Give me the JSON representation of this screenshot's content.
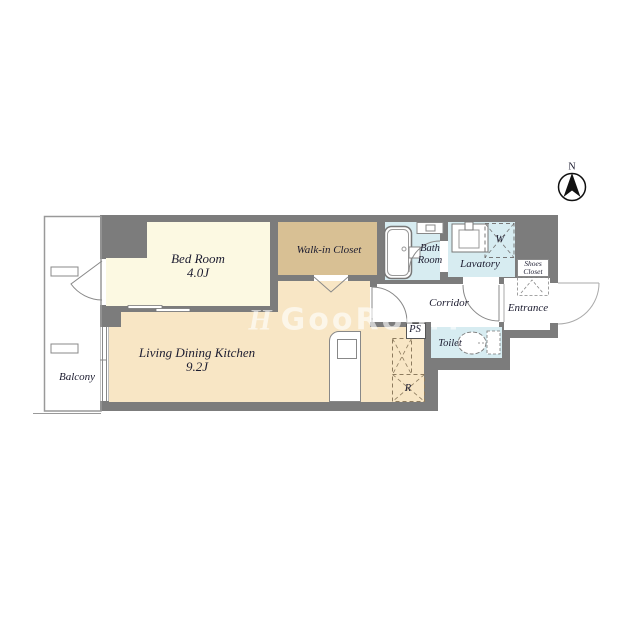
{
  "compass": {
    "label": "N"
  },
  "watermark": {
    "logo": "H",
    "text": "GooRooM"
  },
  "colors": {
    "wall": "#7c7c7c",
    "bedroom_floor": "#fcf9e2",
    "closet_floor": "#d8c094",
    "ldk_floor": "#f8e6c5",
    "wet_area_floor": "#d7ecf1",
    "outline": "#8a8a8a"
  },
  "rooms": {
    "balcony": {
      "label": "Balcony"
    },
    "bedroom": {
      "label": "Bed Room",
      "size": "4.0J"
    },
    "walk_in_closet": {
      "label": "Walk-in Closet"
    },
    "bath": {
      "label_line1": "Bath",
      "label_line2": "Room"
    },
    "lavatory": {
      "label": "Lavatory"
    },
    "washer": {
      "label": "W"
    },
    "shoes_closet": {
      "label_line1": "Shoes",
      "label_line2": "Closet"
    },
    "entrance": {
      "label": "Entrance"
    },
    "corridor": {
      "label": "Corridor"
    },
    "toilet": {
      "label": "Toilet"
    },
    "pipe_space": {
      "label": "PS"
    },
    "refrigerator": {
      "label": "R"
    },
    "ldk": {
      "label": "Living Dining Kitchen",
      "size": "9.2J"
    }
  }
}
